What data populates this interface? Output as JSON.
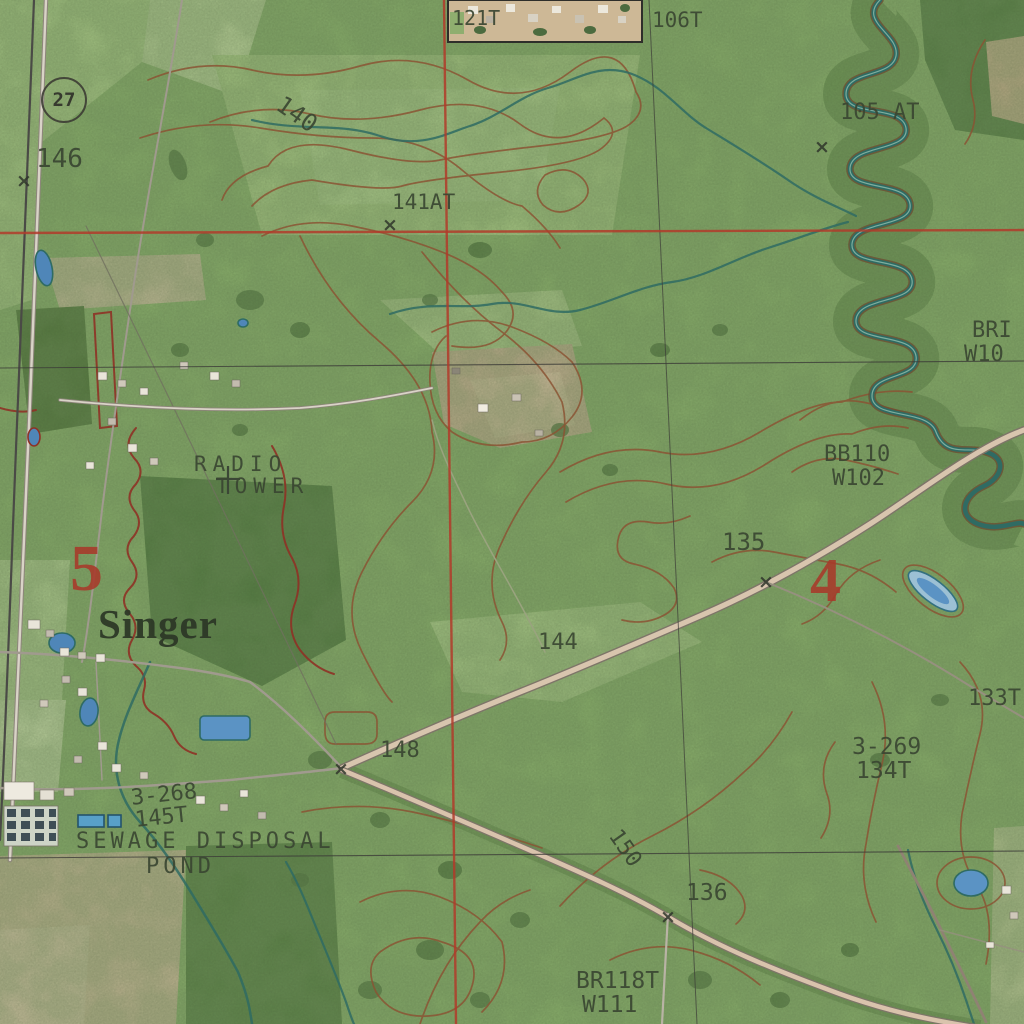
{
  "map": {
    "view": "aerial-topo-hybrid",
    "town_name": "Singer",
    "route_shield": {
      "number": "27"
    },
    "colors": {
      "grid_red": "#b23b2a",
      "grid_black": "#3c3c38",
      "contour_brown": "#8a5434",
      "boundary_red": "#8e3226",
      "stream_teal": "#2f6b63",
      "pond_blue": "#5b93c4",
      "label_dark": "#3a4632",
      "section_red": "#a8392a",
      "base_green": "#8cb26e"
    },
    "x_mark_glyph": "×",
    "labels": [
      {
        "text": "146",
        "x": 36,
        "y": 146,
        "size": 26
      },
      {
        "text": "140",
        "x": 286,
        "y": 92,
        "size": 24,
        "rot": 35
      },
      {
        "text": "121T",
        "x": 452,
        "y": 8,
        "size": 20
      },
      {
        "text": "106T",
        "x": 652,
        "y": 10,
        "size": 21
      },
      {
        "text": "141AT",
        "x": 392,
        "y": 192,
        "size": 21
      },
      {
        "text": "105 AT",
        "x": 840,
        "y": 102,
        "size": 22
      },
      {
        "text": "BRI",
        "x": 972,
        "y": 320,
        "size": 22
      },
      {
        "text": "W10",
        "x": 964,
        "y": 344,
        "size": 22
      },
      {
        "text": "BB110",
        "x": 824,
        "y": 444,
        "size": 22
      },
      {
        "text": "W102",
        "x": 832,
        "y": 468,
        "size": 22
      },
      {
        "text": "135",
        "x": 722,
        "y": 530,
        "size": 24
      },
      {
        "text": "RADIO",
        "x": 194,
        "y": 454,
        "size": 21,
        "ls": 6
      },
      {
        "text": "TOWER",
        "x": 216,
        "y": 476,
        "size": 21,
        "ls": 6
      },
      {
        "text": "5",
        "x": 70,
        "y": 536,
        "size": 66,
        "cls": "section"
      },
      {
        "text": "4",
        "x": 810,
        "y": 550,
        "size": 62,
        "cls": "section"
      },
      {
        "text": "Singer",
        "x": 98,
        "y": 604,
        "size": 41,
        "cls": "town"
      },
      {
        "text": "3-268",
        "x": 130,
        "y": 788,
        "size": 22,
        "rot": -6
      },
      {
        "text": "145T",
        "x": 134,
        "y": 810,
        "size": 22,
        "rot": -6
      },
      {
        "text": "SEWAGE DISPOSAL",
        "x": 76,
        "y": 831,
        "size": 22,
        "ls": 4
      },
      {
        "text": "POND",
        "x": 146,
        "y": 856,
        "size": 22,
        "ls": 4
      },
      {
        "text": "144",
        "x": 538,
        "y": 632,
        "size": 22
      },
      {
        "text": "148",
        "x": 380,
        "y": 740,
        "size": 22
      },
      {
        "text": "150",
        "x": 622,
        "y": 826,
        "size": 22,
        "rot": 55
      },
      {
        "text": "136",
        "x": 686,
        "y": 882,
        "size": 23
      },
      {
        "text": "133T",
        "x": 968,
        "y": 688,
        "size": 22
      },
      {
        "text": "3-269",
        "x": 852,
        "y": 736,
        "size": 23
      },
      {
        "text": "134T",
        "x": 856,
        "y": 760,
        "size": 23
      },
      {
        "text": "BR118T",
        "x": 576,
        "y": 970,
        "size": 23
      },
      {
        "text": "W111",
        "x": 582,
        "y": 994,
        "size": 23
      }
    ],
    "x_marks": [
      {
        "x": 16,
        "y": 172
      },
      {
        "x": 382,
        "y": 216
      },
      {
        "x": 814,
        "y": 138
      },
      {
        "x": 333,
        "y": 760
      },
      {
        "x": 758,
        "y": 573
      },
      {
        "x": 660,
        "y": 908
      }
    ]
  }
}
